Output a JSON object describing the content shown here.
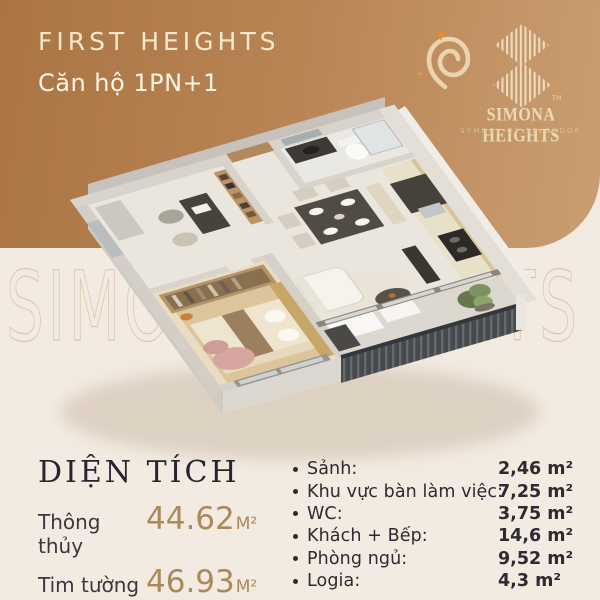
{
  "colors": {
    "band_brown": "#b5804c",
    "background_cream": "#f3ebe2",
    "accent_gold": "#a98a58",
    "text_dark": "#2b2a31",
    "brand_cream": "#eedcbd"
  },
  "header": {
    "project_title": "FIRST HEIGHTS",
    "unit_label": "Căn hộ 1PN+1"
  },
  "brand": {
    "name": "SIMONA HEIGHTS",
    "tagline": "SYMBOL OF SPLENDOR",
    "trademark": "TM",
    "watermark": "SIMONA HEIGHTS",
    "pin_icon": "spiral-pin-icon",
    "mark_icon": "striped-double-diamond-icon"
  },
  "area_summary": {
    "title": "DIỆN TÍCH",
    "rows": [
      {
        "label": "Thông thủy",
        "value": "44.62",
        "unit": "M²"
      },
      {
        "label": "Tim tường",
        "value": "46.93",
        "unit": "M²"
      }
    ]
  },
  "room_areas": {
    "items": [
      {
        "label": "Sảnh:",
        "value": "2,46 m²"
      },
      {
        "label": "Khu vực bàn làm việc:",
        "value": "7,25 m²"
      },
      {
        "label": "WC:",
        "value": "3,75 m²"
      },
      {
        "label": "Khách + Bếp:",
        "value": "14,6 m²"
      },
      {
        "label": "Phòng ngủ:",
        "value": "9,52 m²"
      },
      {
        "label": "Logia:",
        "value": "4,3 m²"
      }
    ]
  }
}
